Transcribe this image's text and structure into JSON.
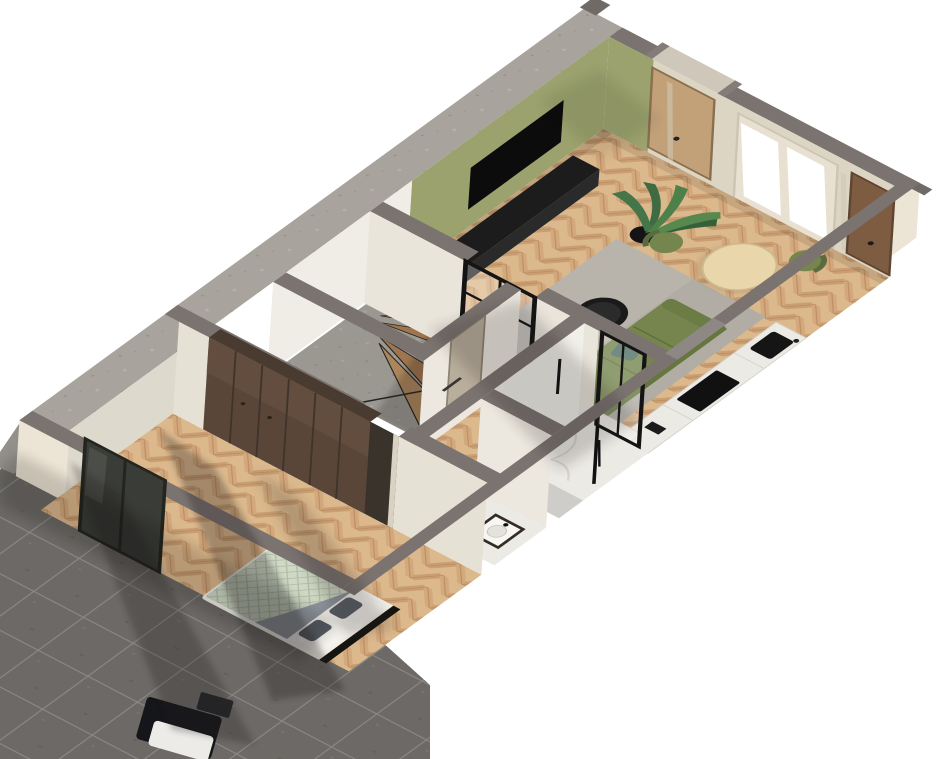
{
  "scene": {
    "type": "3d-floorplan-render",
    "view": "axonometric-dollhouse",
    "description": "Cutaway 3D render of a one-bedroom apartment with terrace",
    "rooms": [
      {
        "name": "living-room",
        "floor": "herringbone-oak",
        "furniture": [
          "sofa",
          "coffee-table",
          "side-table",
          "rug",
          "tv",
          "media-console",
          "potted-plant",
          "dining-table",
          "dining-chairs",
          "kitchen-counter"
        ]
      },
      {
        "name": "entry",
        "furniture": [
          "entry-door"
        ]
      },
      {
        "name": "staircase",
        "floor": "concrete",
        "furniture": [
          "winder-stairs"
        ]
      },
      {
        "name": "hallway",
        "floor": "herringbone-oak",
        "furniture": [
          "glass-door"
        ]
      },
      {
        "name": "shower-room",
        "floor": "marble",
        "furniture": [
          "shower-set"
        ]
      },
      {
        "name": "wc",
        "floor": "marble",
        "furniture": [
          "vanity-sink",
          "toilet"
        ]
      },
      {
        "name": "storage",
        "floor": "screed",
        "furniture": []
      },
      {
        "name": "bedroom",
        "floor": "herringbone-oak",
        "furniture": [
          "double-bed",
          "wardrobe",
          "sliding-glass-door"
        ]
      },
      {
        "name": "terrace",
        "floor": "dark-tiles",
        "furniture": [
          "outdoor-chair"
        ]
      }
    ],
    "colors": {
      "background": "#ffffff",
      "wall_top": "#7b7370",
      "party_wall_top": "#a8a49d",
      "facade": "#ece4d4",
      "wall_face": "#f0ede7",
      "panel_wall": "#dcd5c3",
      "accent_wall": "#9ba26e",
      "floor_oak": "#dcb98d",
      "floor_oak_dark": "#c09058",
      "rug": "#b3aea6",
      "sofa": "#75854d",
      "sofa_dark": "#66763f",
      "sofa_cushion": "#4f6f64",
      "coffee_table": "#1a1a1a",
      "side_table": "#e6dcc0",
      "dining_table": "#e9d6ab",
      "chair": "#75854e",
      "tv": "#0c0c0c",
      "media_console": "#1c1c1c",
      "plant": "#3e6b41",
      "stairs_oak": "#c79c6d",
      "concrete": "#b5b1aa",
      "wardrobe": "#594639",
      "bed_frame": "#f2efe9",
      "bed_duvet": "#cfd9c6",
      "bed_throw": "#8f959d",
      "marble": "#eceae5",
      "fixture_black": "#141414",
      "door_oak": "#c2a179",
      "door_brown": "#7d5c42",
      "terrace_tile": "#6c6966",
      "terrace_grout": "#8b8885",
      "glass_dark": "#3a3c38"
    }
  }
}
